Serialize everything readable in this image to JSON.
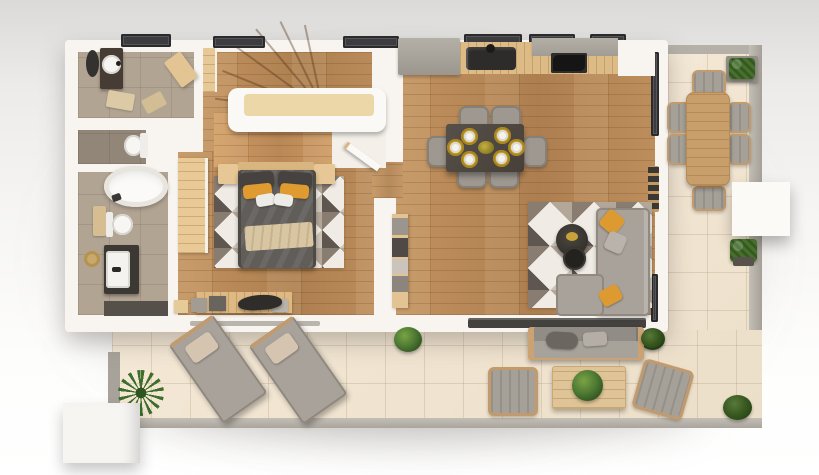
{
  "scene": {
    "title": "Apartment floor plan - photorealistic 3D top-down render",
    "type": "architectural floor plan visualization",
    "no_visible_text": true
  },
  "palette": {
    "wall_white": "#f8f5f0",
    "wood_floor": "#b9895a",
    "bathroom_tile": "#b2a493",
    "terrace_tile": "#f1e4d1",
    "window_glass": "#3d3d3f",
    "accent_orange": "#dd9a31",
    "sofa_grey": "#a8a29b",
    "dining_table_dark": "#4e4842",
    "placemat_yellow": "#c6a02c",
    "furniture_wood": "#d9b57f",
    "plant_green": "#4e7a33",
    "duvet_grey": "#615d59",
    "curb_grey": "#b6b1a8"
  },
  "counts": {
    "dining_chairs": 6,
    "place_settings": 6,
    "terrace_dining_chairs": 6,
    "sun_loungers": 2,
    "outdoor_armchairs": 2,
    "roof_windows_top_wall": 6
  },
  "rooms": {
    "bathroom_top": {
      "label": "Guest bathroom",
      "items": [
        "dark vanity with round washbasin",
        "round dark wall mirror",
        "roof window",
        "two beige bath mats",
        "tilted corner cabinet"
      ]
    },
    "wc": {
      "label": "Separate WC",
      "items": [
        "toilet with cistern"
      ]
    },
    "bathroom_main": {
      "label": "Main bathroom",
      "items": [
        "freestanding oval bathtub",
        "toilet",
        "white washbasin on dark vanity",
        "round jute mat",
        "small wooden stand",
        "dark shower mat"
      ]
    },
    "hall": {
      "label": "Hallway with staircase",
      "items": [
        "curved winder staircase",
        "white balustrade with wood landing",
        "tall wooden cabinet"
      ]
    },
    "bedroom": {
      "label": "Bedroom",
      "items": [
        "double bed with dark grey duvet",
        "two dark grey pillows",
        "two orange accent pillows",
        "two white pillows",
        "beige throw blanket",
        "geometric triangle rug",
        "light wood wardrobe",
        "two nightstands",
        "desk with storage boxes",
        "dark desk chair",
        "open door leaf"
      ]
    },
    "kitchen": {
      "label": "Kitchen",
      "items": [
        "grey base cabinets",
        "wooden worktop",
        "dark double sink with tap",
        "black cooktop",
        "roof windows above counter"
      ]
    },
    "dining": {
      "label": "Dining area",
      "items": [
        "dark rectangular dining table",
        "six grey chairs",
        "six yellow round placemats with white plates",
        "yellow flower centerpiece"
      ]
    },
    "living": {
      "label": "Living area",
      "items": [
        "L-shaped grey sofa",
        "two orange cushions",
        "grey cushion",
        "two round dark coffee tables",
        "geometric triangle rug",
        "wooden sideboard with storage boxes",
        "window shelf with decor"
      ]
    },
    "terrace_side": {
      "label": "Side terrace",
      "items": [
        "wooden outdoor dining table",
        "six outdoor chairs with grey cushions",
        "boxwood planter at top",
        "boxwood in pot",
        "white porch block",
        "grey stone border"
      ]
    },
    "terrace_main": {
      "label": "Main terrace",
      "items": [
        "two sun loungers with beige pillows",
        "outdoor sofa with cushions",
        "two outdoor armchairs",
        "wooden coffee table with plant",
        "green bushes by the glass wall",
        "boxwood in corner",
        "palm plant",
        "white planter cube"
      ]
    }
  }
}
